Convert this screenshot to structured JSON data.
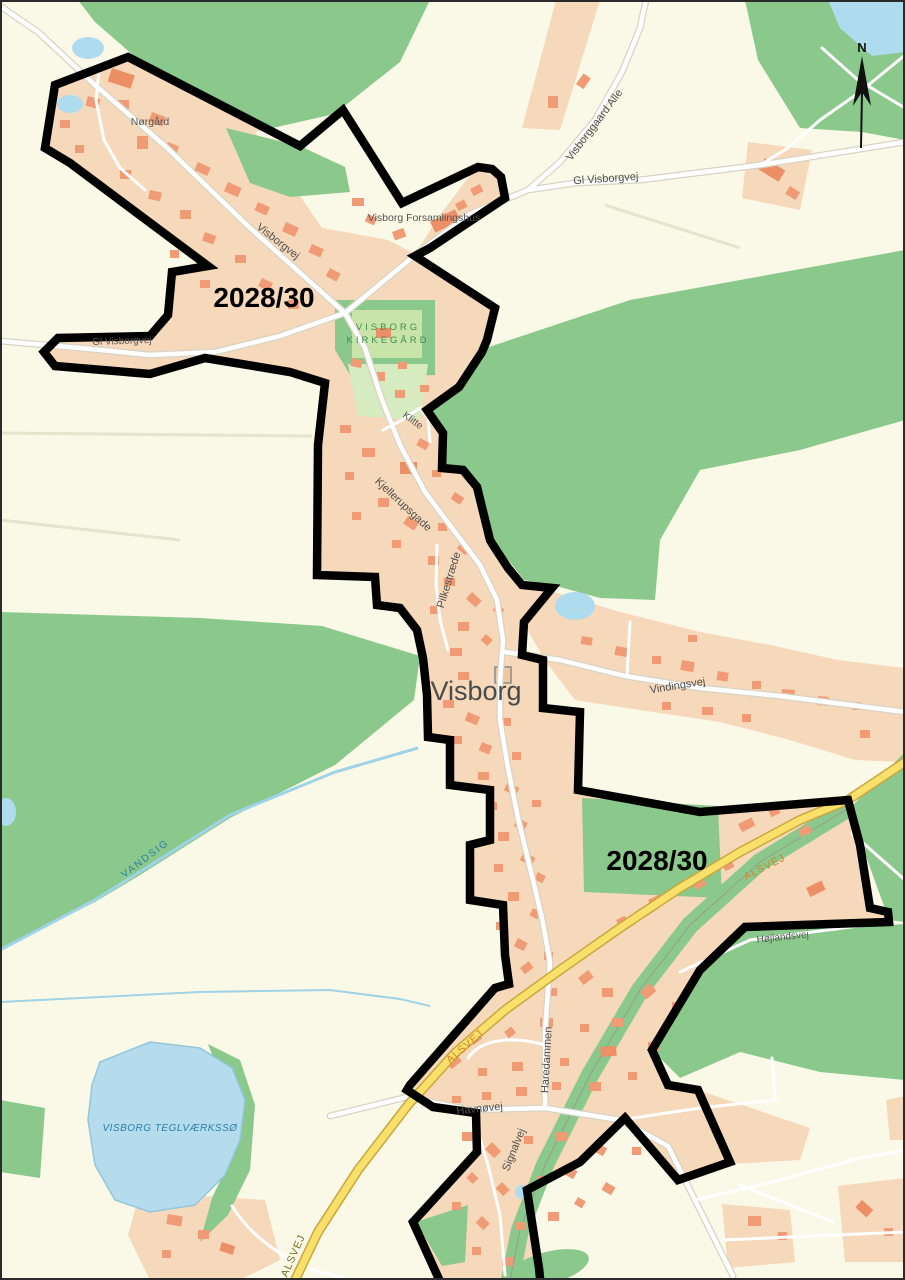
{
  "map": {
    "title_context": "Visborg village plan map",
    "region_labels": {
      "plan_id_north": "2028/30",
      "plan_id_south": "2028/30"
    },
    "town_label": "Visborg",
    "place_labels": {
      "norgard": "Nørgård",
      "forsamlingshus": "Visborg Forsamlingshus",
      "kirkegaard_line1": "VISBORG",
      "kirkegaard_line2": "KIRKEGÅRD"
    },
    "street_labels": {
      "visborgvej": "Visborgvej",
      "gl_visborgvej_west": "Gl Visborgvej",
      "gl_visborgvej_east": "Gl Visborgvej",
      "visborggaard_alle": "Visborggaard Alle",
      "klitte": "Klitte",
      "kjellerupsgade_north": "Kjellerupsgade",
      "kjellerupsgade_south": "Kjellerupsgade",
      "pilkestraede": "Pilkestræde",
      "vindingsvej": "Vindingsvej",
      "alsvej_northeast": "ALSVEJ",
      "alsvej_mid": "ALSVEJ",
      "alsvej_south": "ALSVEJ",
      "hojlandsvej": "Højlandsvej",
      "haredammen": "Haredammen",
      "havnovej": "Havnøvej",
      "signalvej": "Signalvej"
    },
    "water_labels": {
      "vandsig": "VANDSIG",
      "teglvaerksso": "VISBORG TEGLVÆRKSSØ"
    },
    "compass": {
      "north_label": "N"
    },
    "colors": {
      "background": "#FAF8E6",
      "forest_green": "#8AC88C",
      "built_up_area": "#F6D8BA",
      "building": "#F09B76",
      "building_dark": "#ED8F66",
      "water": "#AEDCEE",
      "road_minor": "#FFFFFF",
      "road_primary_yellow": "#F9E06A",
      "plan_boundary": "#000000"
    }
  }
}
